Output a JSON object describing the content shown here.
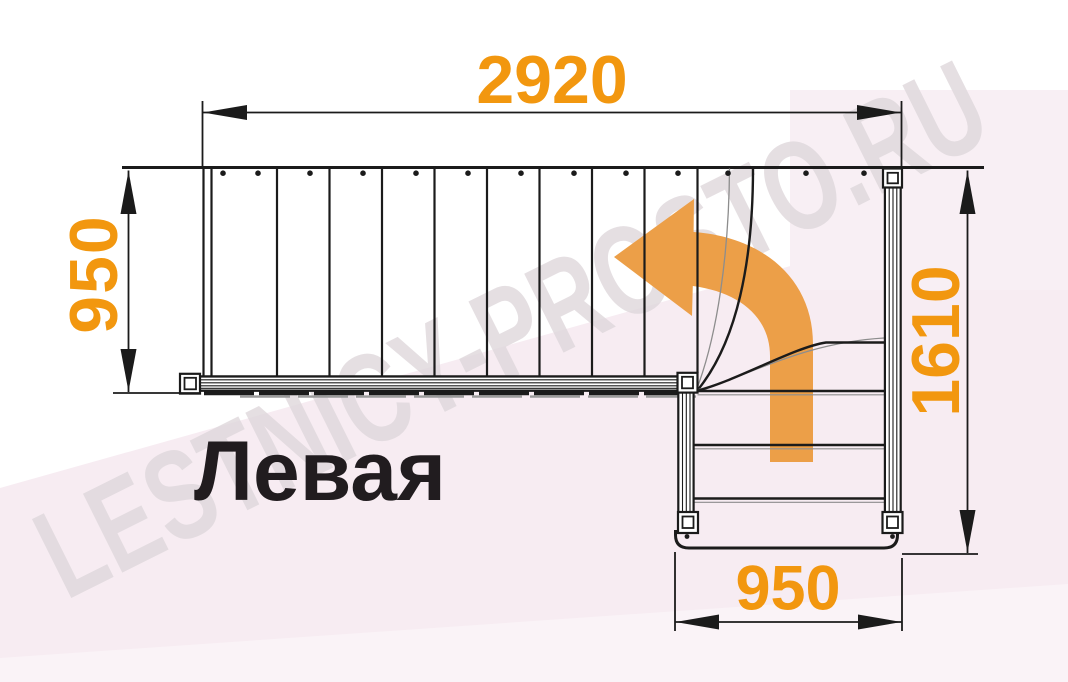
{
  "diagram": {
    "title": "Левая",
    "watermark": "LESTNICY-PROSTO.RU",
    "dimensions": {
      "top_width": "2920",
      "left_depth": "950",
      "right_length": "1610",
      "bottom_width": "950"
    },
    "colors": {
      "dimension_text": "#F2970F",
      "direction_arrow": "#EC9F48",
      "linework": "#1B1B1B",
      "title_text": "#211C1F",
      "background_tint": "#F7ECF2",
      "watermark_text": "#DFD8DC"
    }
  }
}
